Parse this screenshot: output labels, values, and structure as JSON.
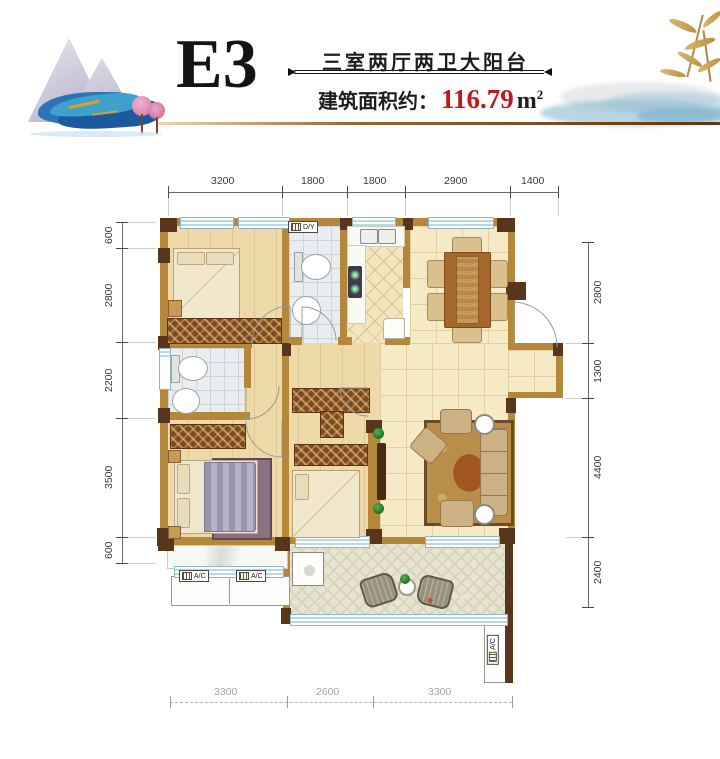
{
  "header": {
    "unit_code": "E3",
    "layout_desc": "三室两厅两卫大阳台",
    "area_label": "建筑面积约：",
    "area_value": "116.79",
    "area_unit": "m",
    "area_sup": "2"
  },
  "dimensions": {
    "top": [
      "3200",
      "1800",
      "1800",
      "2900",
      "1400"
    ],
    "left": [
      "600",
      "2800",
      "2200",
      "3500",
      "600"
    ],
    "right": [
      "2800",
      "1300",
      "4400",
      "2400"
    ],
    "bottom": [
      "3300",
      "2600",
      "3300"
    ]
  },
  "plan": {
    "labels": {
      "dy": "D/Y",
      "ac_left_1": "A/C",
      "ac_left_2": "A/C",
      "ac_right": "A/C"
    }
  },
  "colors": {
    "accent_red": "#c2191c",
    "wall_dark": "#57361d",
    "wall_tan": "#b5873a",
    "window_blue": "#b9d8e6",
    "floor_wood": "#eed9a9",
    "floor_tile": "#e9edef",
    "floor_cream": "#f5e9c6",
    "balcony_tile": "#e7e5d2",
    "rule_brown": "#6b3a1a"
  }
}
